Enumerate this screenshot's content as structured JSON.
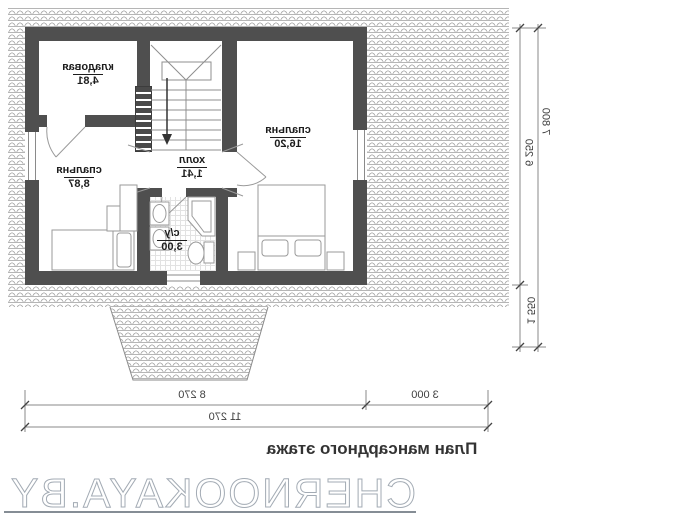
{
  "title": "План мансардного этажа",
  "watermark": "CHERNOOKAYA.BY",
  "rooms": {
    "storage": {
      "name": "кладовая",
      "area": "4,81"
    },
    "bedroom_small": {
      "name": "спальня",
      "area": "8,87"
    },
    "hall": {
      "name": "холл",
      "area": "1,41"
    },
    "bathroom": {
      "name": "с/у",
      "area": "3,00"
    },
    "bedroom_large": {
      "name": "спальня",
      "area": "16,20"
    }
  },
  "dimensions": {
    "building_width": "8 270",
    "side_offset": "3 000",
    "total_width": "11 270",
    "building_depth": "6 250",
    "porch_depth": "1 550",
    "total_depth": "7 800"
  },
  "colors": {
    "wall": "#4f4f4f",
    "hatch": "#b5b5b5",
    "dim": "#6f6f6f",
    "ink": "#1d1d1d",
    "watermark": "#a3abb4"
  }
}
